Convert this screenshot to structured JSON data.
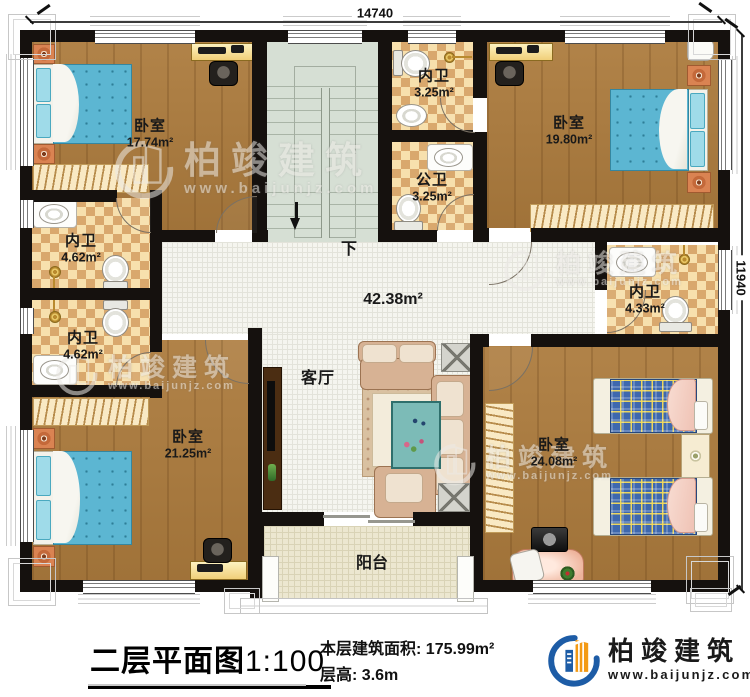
{
  "plan": {
    "dimension_top": "14740",
    "dimension_right": "11940",
    "stair_direction": "下"
  },
  "rooms": {
    "bedroom_tl": {
      "name": "卧室",
      "area": "17.74m²"
    },
    "bedroom_tr": {
      "name": "卧室",
      "area": "19.80m²"
    },
    "bedroom_bl": {
      "name": "卧室",
      "area": "21.25m²"
    },
    "bedroom_br": {
      "name": "卧室",
      "area": "24.08m²"
    },
    "bath_top": {
      "name": "内卫",
      "area": "3.25m²"
    },
    "bath_public": {
      "name": "公卫",
      "area": "3.25m²"
    },
    "bath_left_upper": {
      "name": "内卫",
      "area": "4.62m²"
    },
    "bath_left_lower": {
      "name": "内卫",
      "area": "4.62m²"
    },
    "bath_right": {
      "name": "内卫",
      "area": "4.33m²"
    },
    "hall": {
      "name": "客厅",
      "area": "42.38m²"
    },
    "balcony": {
      "name": "阳台"
    }
  },
  "footer": {
    "plan_title": "二层平面图",
    "plan_scale": "1:100",
    "area_label": "本层建筑面积:",
    "area_value": "175.99m²",
    "floor_height_label": "层高:",
    "floor_height_value": "3.6m"
  },
  "brand": {
    "name": "柏竣建筑",
    "website": "www.baijunjz.com"
  },
  "watermark": {
    "name": "柏竣建筑",
    "website": "www.baijunjz.com"
  },
  "colors": {
    "wall": "#15110e",
    "wood_floor": "#ac7b3d",
    "bath_tile_light": "#f7e0ad",
    "bath_tile_dark": "#d9a86d",
    "hall_tile": "#f5f5ef",
    "stair_floor": "#d6dfd4",
    "balcony_tile": "#ece7d0",
    "bed_blue": "#5cb6d2",
    "twin_bed_plaid": "#3e68ae",
    "brand_blue": "#1d5ca6",
    "brand_orange": "#f39a15"
  }
}
